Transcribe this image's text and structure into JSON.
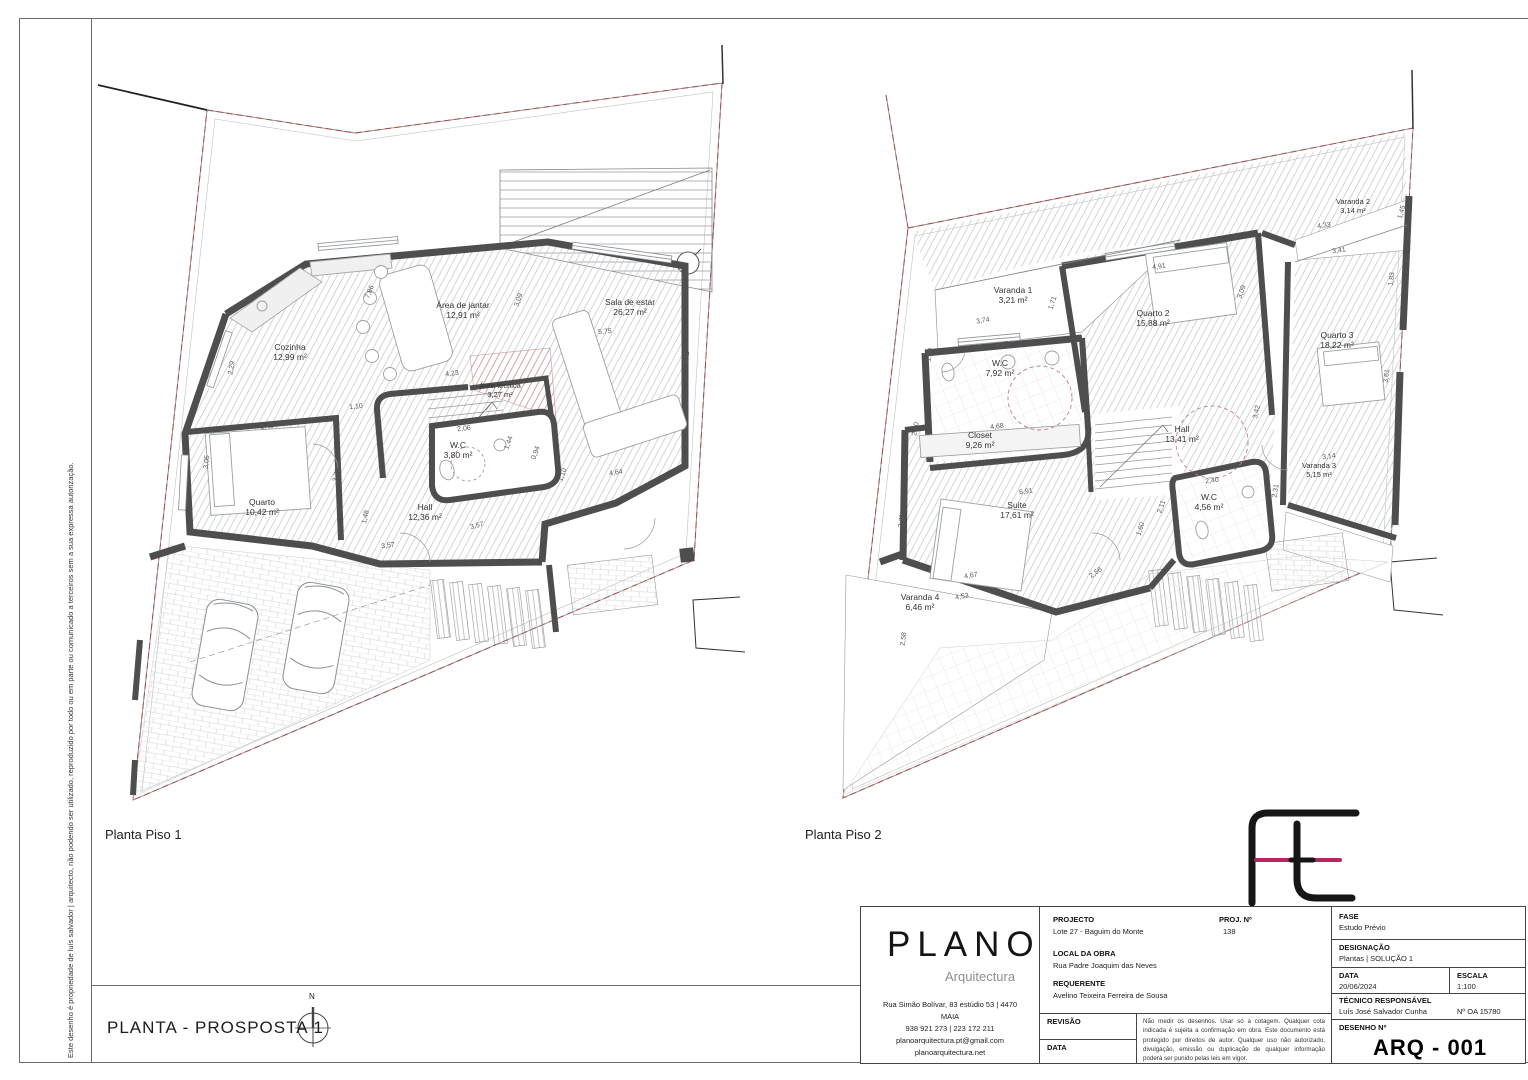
{
  "page": {
    "side_note": "Este desenho é propriedade de luís salvador | arquitecto, não podendo ser utilizado, reproduzido por todo ou em parte ou comunicado a terceiros sem a sua expressa autorização.",
    "bottom_title": "PLANTA - PROSPOSTA 1",
    "north_label": "N"
  },
  "plan1": {
    "caption": "Planta Piso 1",
    "rooms": [
      {
        "name": "Cozinha",
        "area": "12,99 m²"
      },
      {
        "name": "Área de jantar",
        "area": "12,91 m²"
      },
      {
        "name": "Sala de estar",
        "area": "26,27 m²"
      },
      {
        "name": "Área técnica",
        "area": "3,27 m²"
      },
      {
        "name": "W.C",
        "area": "3,80 m²"
      },
      {
        "name": "Quarto",
        "area": "10,42 m²"
      },
      {
        "name": "Hall",
        "area": "12,36 m²"
      }
    ],
    "dims": [
      "5,75",
      "7,86",
      "3,09",
      "4,23",
      "1,10",
      "3,43",
      "2,29",
      "3,05",
      "3,78",
      "1,48",
      "2,06",
      "1,44",
      "0,94",
      "1,10",
      "4,64",
      "5,11",
      "3,57",
      "3,57"
    ]
  },
  "plan2": {
    "caption": "Planta Piso 2",
    "rooms": [
      {
        "name": "Varanda 1",
        "area": "3,21 m²"
      },
      {
        "name": "Quarto 2",
        "area": "15,88 m²"
      },
      {
        "name": "Varanda 2",
        "area": "3,14 m²"
      },
      {
        "name": "Quarto 3",
        "area": "18,22 m²"
      },
      {
        "name": "W.C",
        "area": "7,92 m²"
      },
      {
        "name": "Closet",
        "area": "9,26 m²"
      },
      {
        "name": "Hall",
        "area": "13,41 m²"
      },
      {
        "name": "Suite",
        "area": "17,61 m²"
      },
      {
        "name": "W.C",
        "area": "4,56 m²"
      },
      {
        "name": "Varanda 3",
        "area": "5,15 m²"
      },
      {
        "name": "Varanda 4",
        "area": "6,46 m²"
      }
    ],
    "dims": [
      "3,74",
      "1,71",
      "4,91",
      "4,17",
      "1,50",
      "2,30",
      "4,68",
      "6,91",
      "2,72",
      "4,67",
      "4,53",
      "2,56",
      "1,60",
      "2,11",
      "2,40",
      "2,31",
      "3,42",
      "3,09",
      "3,41",
      "1,83",
      "3,61",
      "3,14",
      "4,33",
      "1,45",
      "2,58"
    ]
  },
  "title_block": {
    "firm": {
      "name": "PLANO",
      "subtitle": "Arquitectura",
      "address1": "Rua Simão Bolívar, 83 estúdio 53 | 4470",
      "address2": "MAIA",
      "phone": "938 921 273 | 223 172 211",
      "email": "planoarquitectura.pt@gmail.com",
      "website": "planoarquitectura.net"
    },
    "projecto_label": "PROJECTO",
    "projecto_value": "Lote 27 - Baguim do Monte",
    "proj_no_label": "PROJ. Nº",
    "proj_no_value": "138",
    "local_label": "LOCAL DA OBRA",
    "local_value": "Rua Padre Joaquim das Neves",
    "requerente_label": "REQUERENTE",
    "requerente_value": "Avelino Teixeira Ferreira de Sousa",
    "revisao_label": "REVISÃO",
    "data_label": "DATA",
    "disclaimer": "Não medir os desenhos. Usar só a cotagem. Qualquer cota indicada é sujeita a confirmação em obra. Este documento está protegido por direitos de autor. Qualquer uso não autorizado, divulgação, emissão ou duplicação de qualquer informação poderá ser punido pelas leis em vigor.",
    "fase_label": "FASE",
    "fase_value": "Estudo Prévio",
    "designacao_label": "DESIGNAÇÃO",
    "designacao_value": "Plantas | SOLUÇÃO 1",
    "data2_label": "DATA",
    "data2_value": "20/06/2024",
    "escala_label": "ESCALA",
    "escala_value": "1:100",
    "tecnico_label": "TÉCNICO RESPONSÁVEL",
    "tecnico_value": "Luís José Salvador Cunha",
    "oa_value": "Nº OA 15780",
    "desenho_label": "DESENHO Nº",
    "desenho_value": "ARQ - 001"
  },
  "colors": {
    "wall": "#4e4e4e",
    "boundary_red": "#a84848",
    "accent_magenta": "#b9255f"
  }
}
